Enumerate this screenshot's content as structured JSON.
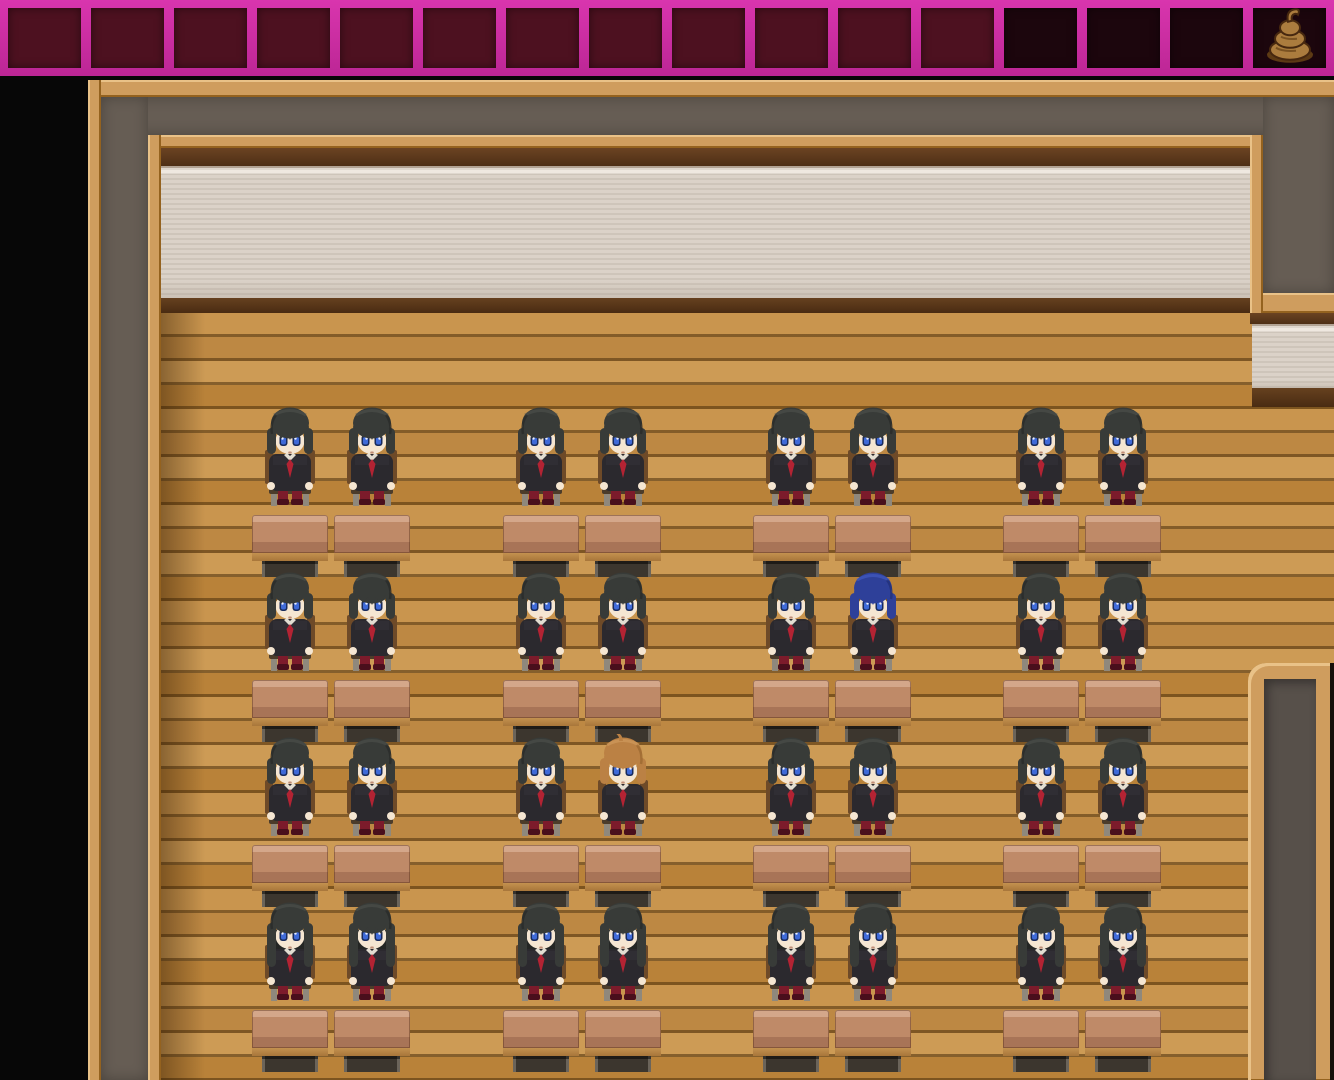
{
  "scene_type": "rpg-maker-classroom-map",
  "window": {
    "width": 1334,
    "height": 1080
  },
  "tile_strip": {
    "name": "hallway-wall-tiles",
    "cell_count": 16,
    "dark_cells_start_index": 12,
    "cell_color": "#4d1120",
    "dark_cell_color": "#1c060d",
    "grout_color": "#cb2aa0",
    "icon": {
      "name": "poop-icon",
      "cell_index": 15,
      "colors": {
        "body": "#ab7c3e",
        "outline": "#47280f",
        "shadow": "#5d3a14",
        "detail": "#7a5222"
      }
    }
  },
  "classroom": {
    "seat_centers_x": [
      290,
      372,
      541,
      623,
      791,
      873,
      1041,
      1123
    ],
    "student_row_tops_y": [
      404,
      569,
      734,
      899
    ],
    "desk_row_tops_y": [
      515,
      680,
      845,
      1010
    ],
    "desk": {
      "width": 76
    },
    "rows": [
      {
        "variant": "bob",
        "hair": [
          "dark",
          "dark",
          "dark",
          "dark",
          "dark",
          "dark",
          "dark",
          "dark"
        ]
      },
      {
        "variant": "bob",
        "hair": [
          "dark",
          "dark",
          "dark",
          "dark",
          "dark",
          "blue",
          "dark",
          "dark"
        ]
      },
      {
        "variant": "bob",
        "hair": [
          "dark",
          "dark",
          "dark",
          "orange",
          "dark",
          "dark",
          "dark",
          "dark"
        ]
      },
      {
        "variant": "long",
        "hair": [
          "dark",
          "dark",
          "dark",
          "dark",
          "dark",
          "dark",
          "dark",
          "dark"
        ]
      }
    ],
    "special_characters": [
      {
        "role": "blue-haired-student",
        "row": 1,
        "seat": 5,
        "hair": "blue"
      },
      {
        "role": "orange-haired-student",
        "row": 2,
        "seat": 3,
        "hair": "orange"
      }
    ],
    "student_count": 32
  },
  "palette": {
    "hair": {
      "dark": {
        "base": "#383b38",
        "light": "#51554f",
        "shade": "#242624"
      },
      "blue": {
        "base": "#2e4099",
        "light": "#4a63cf",
        "shade": "#1e2c6e"
      },
      "orange": {
        "base": "#bb8144",
        "light": "#d8a466",
        "shade": "#93622c"
      }
    },
    "uniform": {
      "blazer": "#2b292e",
      "blazer_light": "#35333a",
      "tie": "#b32333",
      "skin": "#f5e6d2",
      "eye_dark": "#182a5c",
      "eye_iris": "#3f6ad8",
      "socks": "#7c1b2b",
      "shoes": "#490f1c",
      "collar": "#e3ded2"
    },
    "chair": {
      "wood": "#6e4a28",
      "seat": "#4c3c2a",
      "legs": "#8f887c"
    },
    "room": {
      "floor": "#c6924b",
      "wall_beige": "#d9d0c6",
      "wall_gray": "#665d54",
      "frame_tan": "#cf9d5e",
      "background": "#070707"
    }
  }
}
